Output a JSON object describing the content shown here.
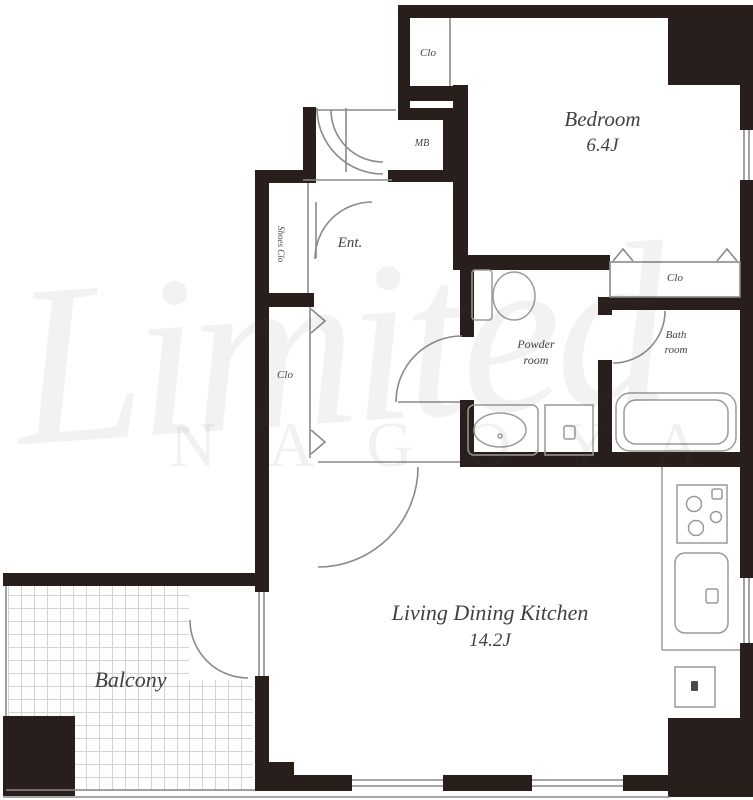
{
  "title": "Apartment floor plan",
  "watermark": {
    "script": "Limited",
    "caps": "NAGOYA"
  },
  "rooms": {
    "bedroom": {
      "name": "Bedroom",
      "size": "6.4J"
    },
    "ldk": {
      "name": "Living Dining Kitchen",
      "size": "14.2J"
    },
    "balcony": {
      "name": "Balcony"
    },
    "powder": {
      "line1": "Powder",
      "line2": "room"
    },
    "bath": {
      "line1": "Bath",
      "line2": "room"
    },
    "entrance": {
      "name": "Ent."
    },
    "shoes_closet": {
      "name": "Shoes Clo"
    },
    "closet_top": {
      "name": "Clo"
    },
    "closet_hall": {
      "name": "Clo"
    },
    "closet_bath": {
      "name": "Clo"
    },
    "meter_box": {
      "name": "MB"
    }
  },
  "colors": {
    "wall": "#281f1c",
    "thin_line": "#8a8a8a",
    "label": "#414141",
    "tile_line": "#d4d4d4"
  }
}
